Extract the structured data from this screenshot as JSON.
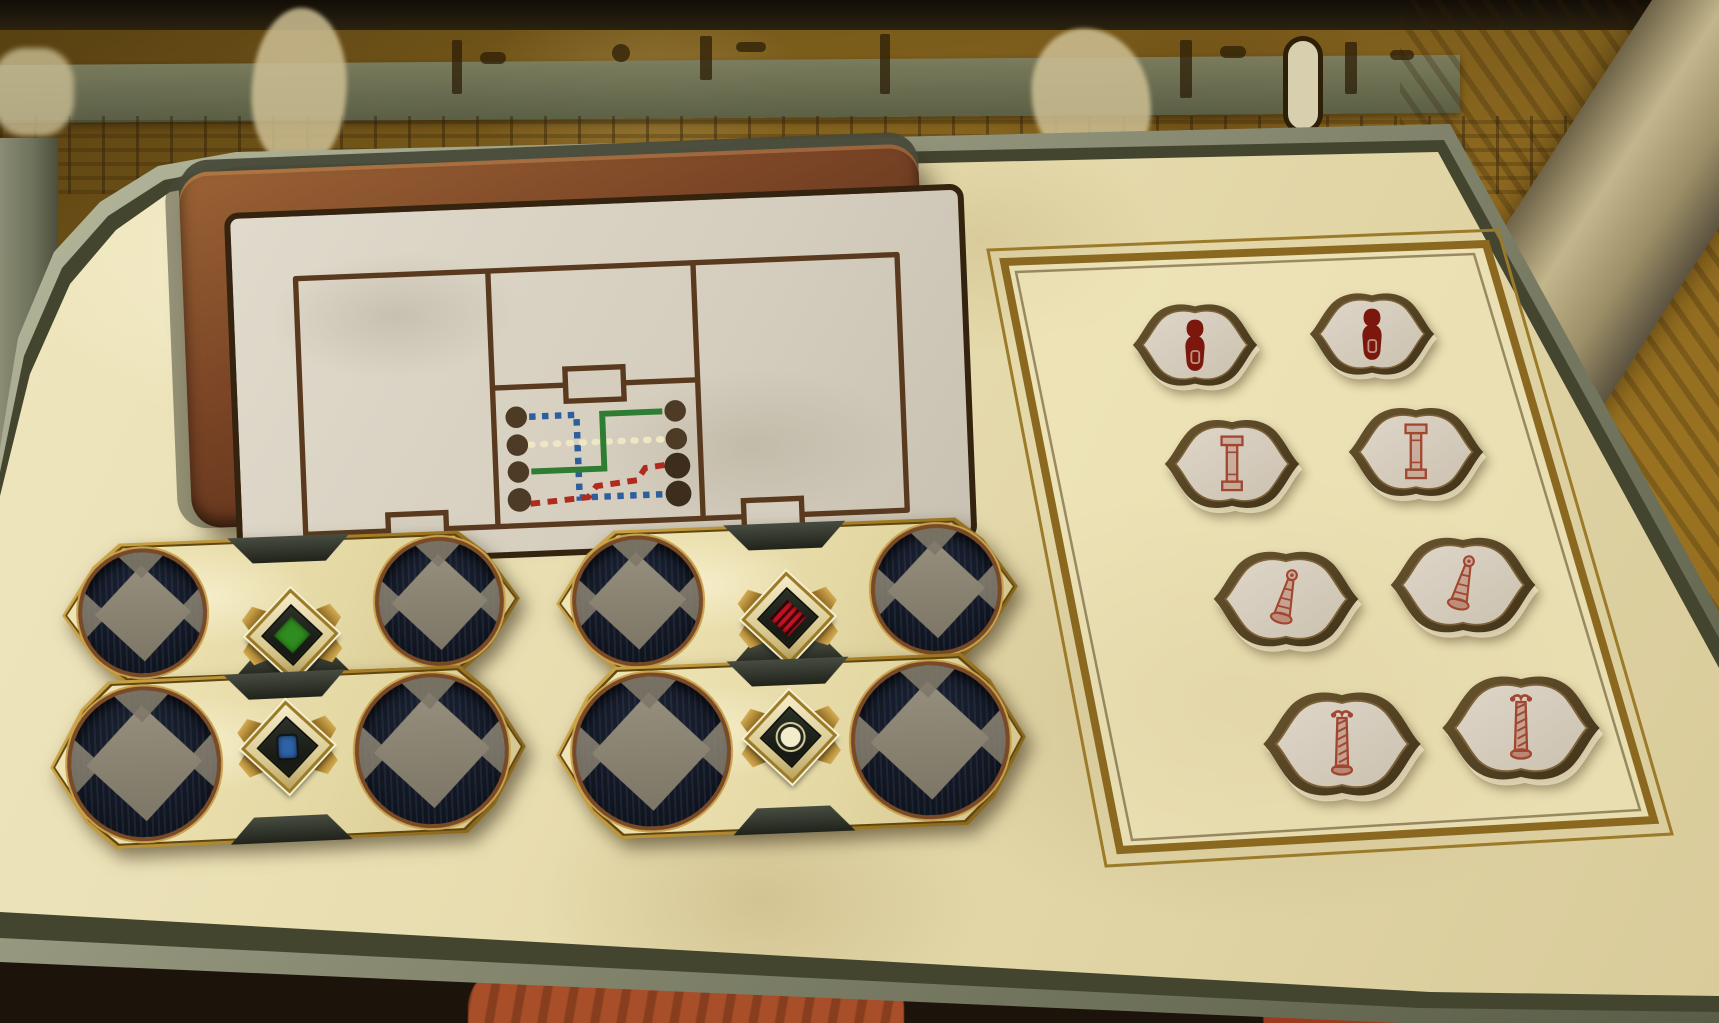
{
  "scene_kind": "egyptian-tomb-puzzle-table",
  "colors": {
    "board_face": "#e7dcae",
    "board_rim_stone": "#8e9077",
    "map_frame_bronze": "#7b4526",
    "map_parchment": "#d5cebe",
    "map_ink": "#5a3a1e",
    "plate_gold": "#a87f26",
    "disc_navy": "#10151f",
    "diamond_gray": "#8a8372",
    "mural_ochre": "#8f6a20",
    "pot_terracotta": "#a84e28"
  },
  "map_panel": {
    "chambers": 3,
    "doorways": 3,
    "peg_color": "#4e3b26",
    "peg_rows": 4,
    "peg_columns": 2,
    "routes": [
      {
        "name": "blue-route",
        "color": "#2d5f9e",
        "style": "square-dotted",
        "from": "left-peg-1",
        "to": "right-peg-4"
      },
      {
        "name": "white-route",
        "color": "#efe6c4",
        "style": "round-dotted",
        "from": "left-peg-2",
        "to": "right-peg-2"
      },
      {
        "name": "green-route",
        "color": "#2e7d32",
        "style": "solid",
        "from": "left-peg-3",
        "to": "right-peg-1"
      },
      {
        "name": "red-route",
        "color": "#b02a1e",
        "style": "dashed",
        "from": "left-peg-4",
        "to": "right-peg-3"
      }
    ]
  },
  "sliders": [
    {
      "position": "top-left",
      "gem": "green",
      "gem_color": "#2f8c1e",
      "gem_shape": "diamond"
    },
    {
      "position": "top-right",
      "gem": "red",
      "gem_color": "#c41420",
      "gem_shape": "striped-diamond"
    },
    {
      "position": "bottom-left",
      "gem": "blue",
      "gem_color": "#2e63a8",
      "gem_shape": "square"
    },
    {
      "position": "bottom-right",
      "gem": "white",
      "gem_color": "#f2ecca",
      "gem_shape": "circle"
    }
  ],
  "token_tray": {
    "rows": 4,
    "columns": 2,
    "glyph_color_dark": "#7c170e",
    "glyph_color_light": "#a1462f",
    "tokens": [
      {
        "row": 1,
        "col": "left",
        "glyph": "ushabti-figure"
      },
      {
        "row": 1,
        "col": "right",
        "glyph": "ushabti-figure"
      },
      {
        "row": 2,
        "col": "left",
        "glyph": "square-pillar"
      },
      {
        "row": 2,
        "col": "right",
        "glyph": "square-pillar"
      },
      {
        "row": 3,
        "col": "left",
        "glyph": "flared-horn"
      },
      {
        "row": 3,
        "col": "right",
        "glyph": "flared-horn"
      },
      {
        "row": 4,
        "col": "left",
        "glyph": "twisted-column"
      },
      {
        "row": 4,
        "col": "right",
        "glyph": "twisted-column"
      }
    ]
  }
}
